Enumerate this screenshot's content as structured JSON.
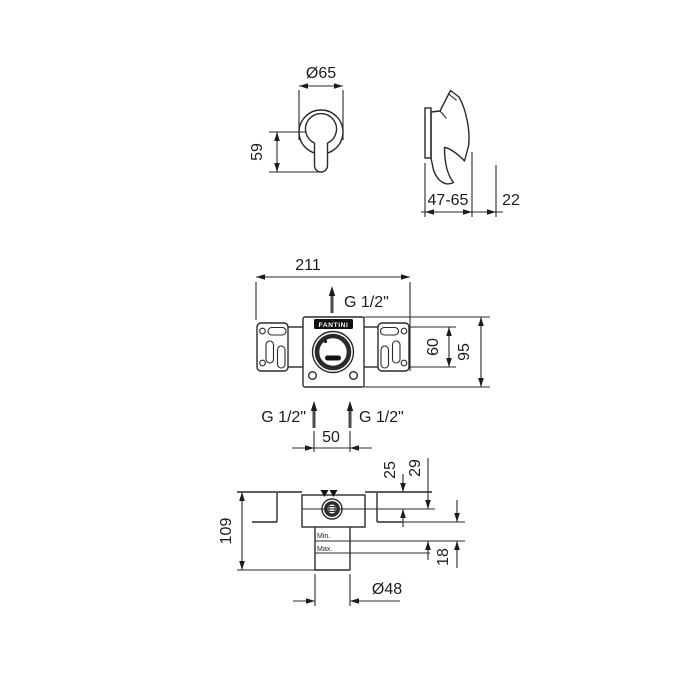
{
  "drawing": {
    "brand": "FANTINI",
    "front_view": {
      "diameter": "Ø65",
      "handle_drop": "59"
    },
    "side_view": {
      "wall_depth_range": "47-65",
      "handle_projection": "22"
    },
    "bracket_view": {
      "width": "211",
      "thread_top": "G 1/2\"",
      "bracket_height": "60",
      "plate_height": "95"
    },
    "inlets": {
      "left_thread": "G 1/2\"",
      "right_thread": "G 1/2\"",
      "spacing": "50"
    },
    "section_view": {
      "total_depth": "109",
      "wall_to_center": "25",
      "center_to_min": "29",
      "adjust_range": "18",
      "min_label": "Min.",
      "max_label": "Max.",
      "cylinder_diameter": "Ø48"
    }
  }
}
